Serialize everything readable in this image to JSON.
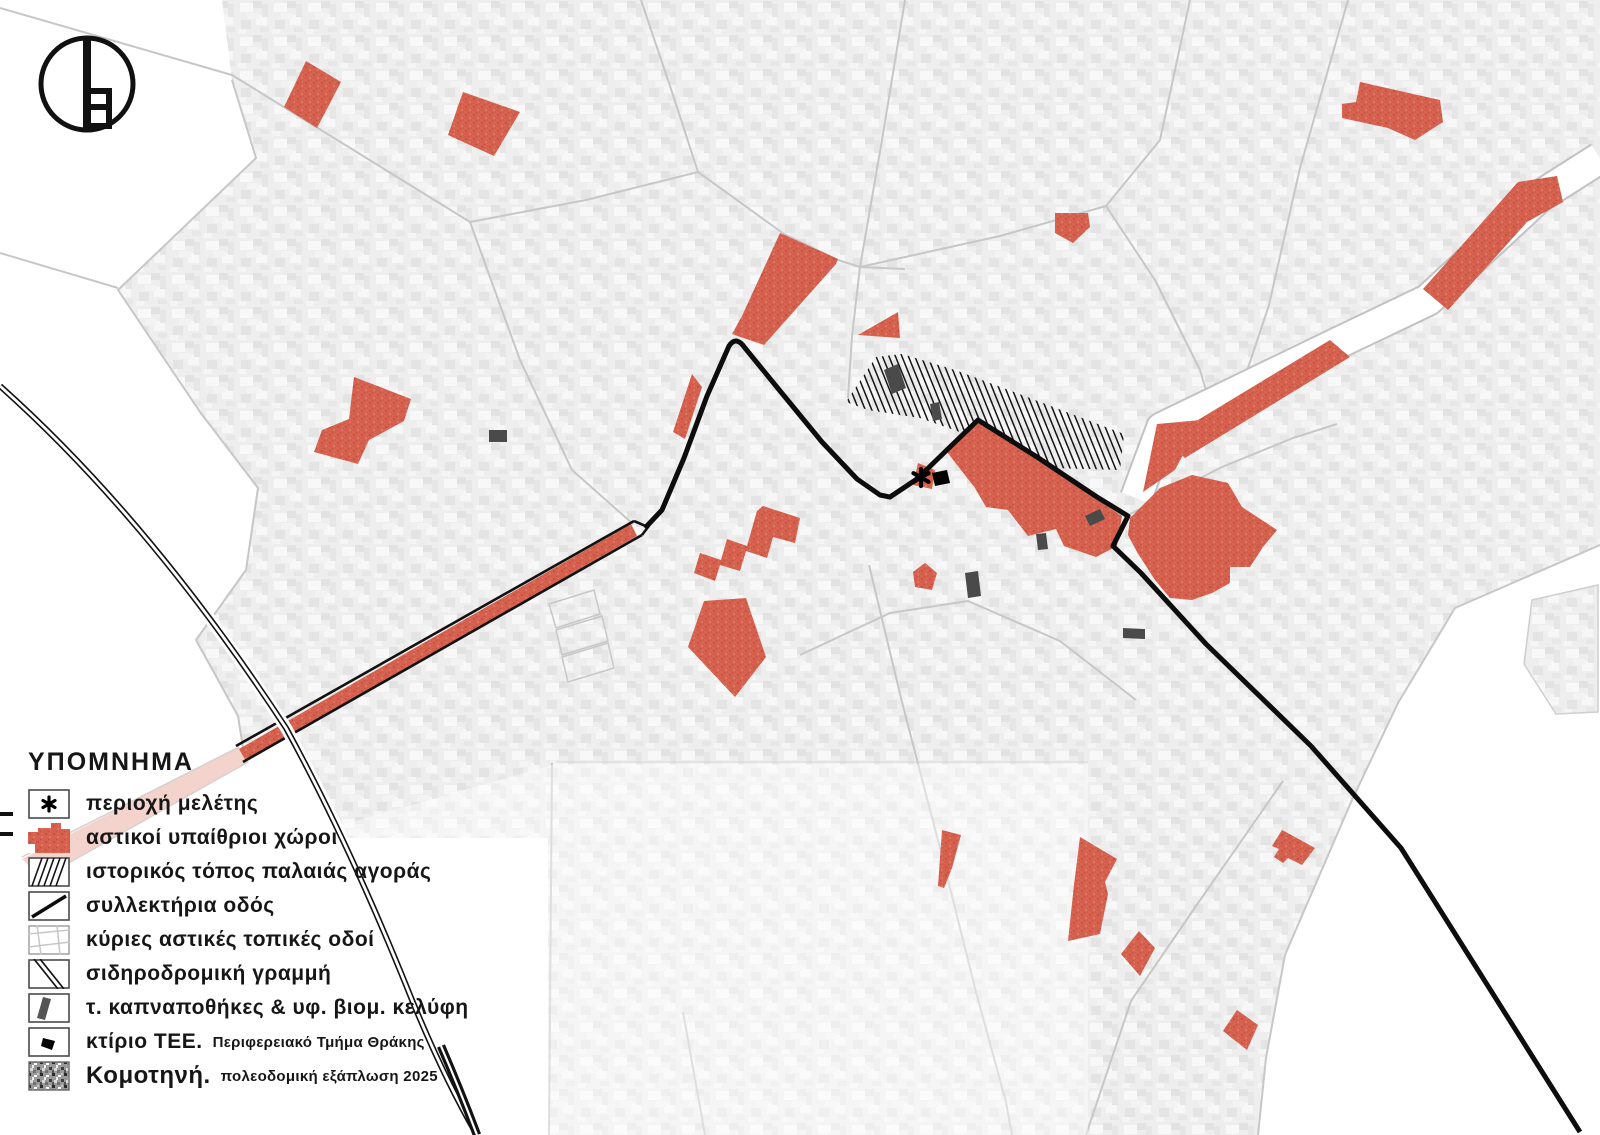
{
  "logo": {
    "letter": "b"
  },
  "legend": {
    "title": "ΥΠΟΜΝΗΜΑ",
    "rows": [
      {
        "id": "study-area",
        "label": "περιοχή μελέτης",
        "sublabel": "",
        "swatch": "asterisk-box"
      },
      {
        "id": "urban-open-spaces",
        "label": "αστικοί υπαίθριοι χώροι",
        "sublabel": "",
        "swatch": "red-polygon"
      },
      {
        "id": "historic-market",
        "label": "ιστορικός τόπος παλαιάς αγοράς",
        "sublabel": "",
        "swatch": "diagonal-hatch"
      },
      {
        "id": "collector-road",
        "label": "συλλεκτήρια οδός",
        "sublabel": "",
        "swatch": "thick-black-line"
      },
      {
        "id": "main-local-roads",
        "label": "κύριες αστικές τοπικές οδοί",
        "sublabel": "",
        "swatch": "thin-gray-lines"
      },
      {
        "id": "railway-line",
        "label": "σιδηροδρομική γραμμή",
        "sublabel": "",
        "swatch": "double-diagonal-line"
      },
      {
        "id": "tobacco-warehouses",
        "label": "τ. καπναποθήκες & υφ. βιομ. κελύφη",
        "sublabel": "",
        "swatch": "dark-gray-parallelogram"
      },
      {
        "id": "tee-building",
        "label": "κτίριο ΤΕΕ.",
        "sublabel": "Περιφερειακό Τμήμα Θράκης",
        "swatch": "black-rotated-square"
      },
      {
        "id": "komotini-expansion",
        "label": "Κομοτηνή.",
        "sublabel": "πολεοδομική εξάπλωση 2025",
        "swatch": "noise-texture"
      }
    ]
  },
  "map": {
    "study_area_marker": "asterisk",
    "colors": {
      "accent_red": "#d5604e",
      "pink_faded": "#f4d3cd",
      "road_black": "#121212",
      "building_gray": "#4a4a4a",
      "urban_texture_gray": "#ececec",
      "local_road_gray": "#c7c7c7"
    }
  }
}
